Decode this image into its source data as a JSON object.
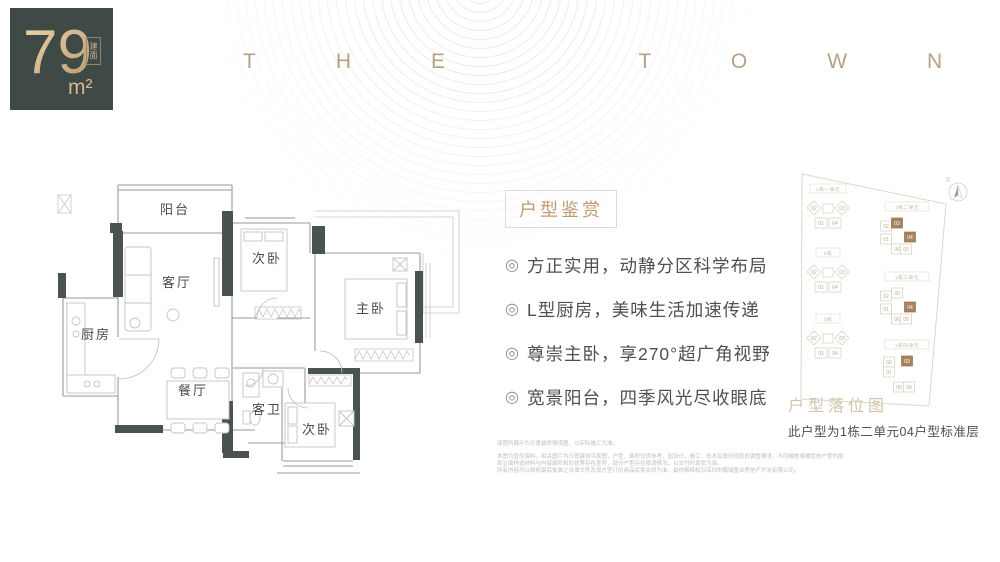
{
  "badge": {
    "area": "79",
    "unit": "m²",
    "tag": "建面"
  },
  "brand": {
    "name": "THE TOWN"
  },
  "floor_plan": {
    "balcony": "阳台",
    "living_room": "客厅",
    "bedroom_top": "次卧",
    "master_bedroom": "主卧",
    "kitchen": "厨房",
    "dining_room": "餐厅",
    "guest_bath": "客卫",
    "bedroom_bottom": "次卧"
  },
  "features": {
    "header": "户型鉴赏",
    "bullet": "◎",
    "items": [
      "方正实用，动静分区科学布局",
      "L型厨房，美味生活加速传递",
      "尊崇主卧，享270°超广角视野",
      "宽景阳台，四季风光尽收眼底"
    ]
  },
  "site_plan": {
    "title": "户型落位图",
    "caption": "此户型为1栋二单元04户型标准层",
    "compass": "北",
    "left_clusters": [
      {
        "label": "1栋一单元",
        "units": [
          "02",
          "03",
          "01",
          "04"
        ]
      },
      {
        "label": "2栋",
        "units": [
          "02",
          "03",
          "01",
          "04"
        ]
      },
      {
        "label": "3栋",
        "units": [
          "02",
          "03",
          "01",
          "04"
        ]
      }
    ],
    "right_clusters": [
      {
        "label": "1栋二单元",
        "units": [
          "02",
          "03",
          "01",
          "04",
          "06",
          "05"
        ]
      },
      {
        "label": "1栋三单元",
        "units": [
          "02",
          "03",
          "01",
          "04",
          "06",
          "05"
        ]
      },
      {
        "label": "1栋四单元",
        "units": [
          "02",
          "03",
          "01",
          "05",
          "04"
        ]
      }
    ],
    "highlight_color": "#a8825f"
  },
  "disclaimer": {
    "lines": [
      "该图所展示为示意装修情境图，以实际施工为准。",
      "本图为宣传资料，相关图片为示意建设平面图，户型、面积仅供参考，因设计、施工、技术及政府规划的调整要求，不同楼栋或楼层的户型的局",
      "部立面构造材料与内部面积和形状等存在差异，部分户型存在微调情况，以交付时现状为准。",
      "所有内容均以政府最后批准之法律文件及双方签订的商品买卖合同为准，最终解释权归深圳市鹏瑞置业房地产开发有限公司。"
    ]
  }
}
